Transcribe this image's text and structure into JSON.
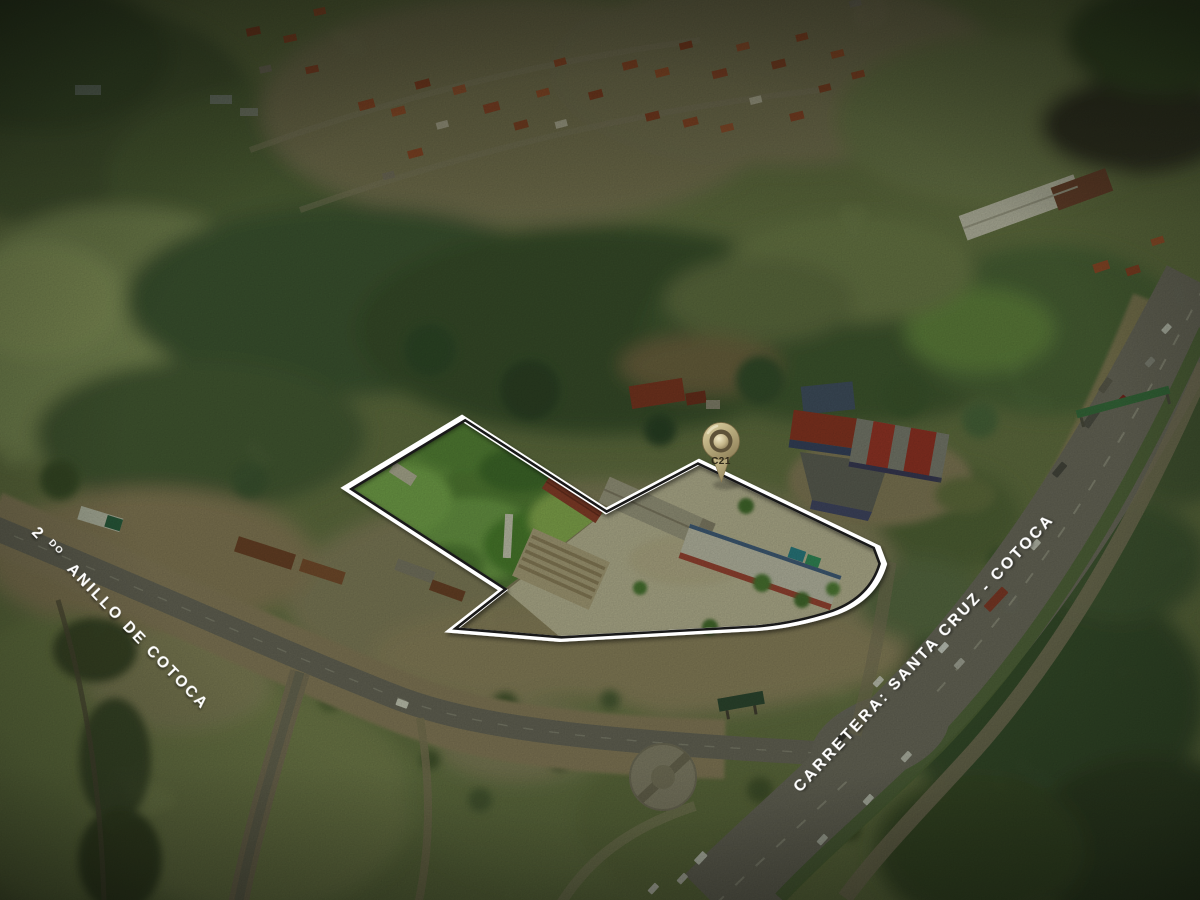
{
  "pin": {
    "label": "C21",
    "gold_color": "#b9ac7e",
    "dark_hole_color": "#5e5238"
  },
  "labels": {
    "left": {
      "prefix": "2",
      "superscript": "DO",
      "rest": "ANILLO DE COTOCA"
    },
    "right": {
      "text": "CARRETERA: SANTA CRUZ - COTOCA"
    }
  },
  "outline": {
    "outer_color": "#ffffff",
    "inner_color": "#191919"
  }
}
